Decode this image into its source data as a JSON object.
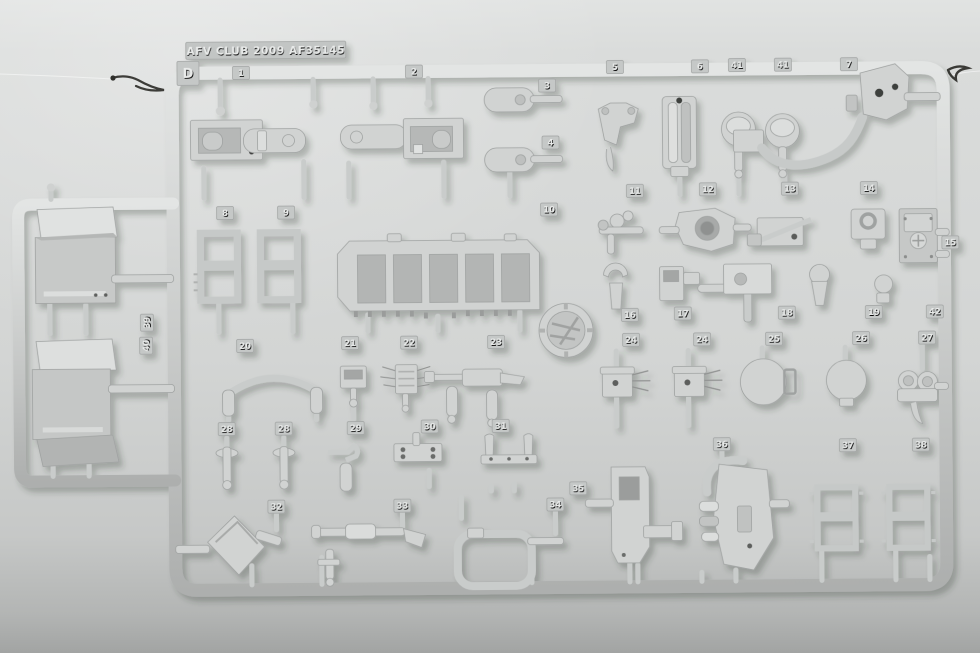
{
  "photo": {
    "brand_plate_text": "AFV CLUB 2009 AF35145",
    "sprue_letter": "D"
  },
  "colors": {
    "background_top": "#e0e2e1",
    "background_mid": "#d5d7d6",
    "background_bottom": "#a6a8a7",
    "plastic_light": "#e0e2e1",
    "plastic_mid": "#cdcfce",
    "plastic_dark": "#b2b4b3",
    "tag_plate": "#c5c8c7",
    "tag_numeral": "#e9ebea",
    "hole_dark": "#4b4d4c"
  },
  "sprue": {
    "letter_tag": {
      "label": "D",
      "x": 190,
      "y": 71,
      "w": 22,
      "h": 24,
      "fs": 13
    },
    "tags": [
      {
        "label": "1",
        "x": 243,
        "y": 71
      },
      {
        "label": "2",
        "x": 416,
        "y": 71
      },
      {
        "label": "3",
        "x": 549,
        "y": 86
      },
      {
        "label": "4",
        "x": 552,
        "y": 143
      },
      {
        "label": "5",
        "x": 617,
        "y": 68
      },
      {
        "label": "6",
        "x": 702,
        "y": 68
      },
      {
        "label": "41",
        "x": 739,
        "y": 67
      },
      {
        "label": "41",
        "x": 785,
        "y": 67
      },
      {
        "label": "7",
        "x": 851,
        "y": 67
      },
      {
        "label": "8",
        "x": 226,
        "y": 211
      },
      {
        "label": "9",
        "x": 287,
        "y": 211
      },
      {
        "label": "10",
        "x": 550,
        "y": 210
      },
      {
        "label": "11",
        "x": 636,
        "y": 192
      },
      {
        "label": "12",
        "x": 709,
        "y": 191
      },
      {
        "label": "13",
        "x": 791,
        "y": 191
      },
      {
        "label": "14",
        "x": 870,
        "y": 191
      },
      {
        "label": "15",
        "x": 951,
        "y": 246
      },
      {
        "label": "16",
        "x": 630,
        "y": 316
      },
      {
        "label": "17",
        "x": 683,
        "y": 315
      },
      {
        "label": "18",
        "x": 787,
        "y": 315
      },
      {
        "label": "19",
        "x": 874,
        "y": 315
      },
      {
        "label": "42",
        "x": 935,
        "y": 315
      },
      {
        "label": "24",
        "x": 631,
        "y": 341
      },
      {
        "label": "24",
        "x": 702,
        "y": 341
      },
      {
        "label": "25",
        "x": 774,
        "y": 341
      },
      {
        "label": "26",
        "x": 861,
        "y": 341
      },
      {
        "label": "27",
        "x": 927,
        "y": 341
      },
      {
        "label": "20",
        "x": 245,
        "y": 344
      },
      {
        "label": "21",
        "x": 350,
        "y": 342
      },
      {
        "label": "22",
        "x": 409,
        "y": 342
      },
      {
        "label": "23",
        "x": 496,
        "y": 342
      },
      {
        "label": "28",
        "x": 226,
        "y": 427
      },
      {
        "label": "28",
        "x": 283,
        "y": 427
      },
      {
        "label": "29",
        "x": 355,
        "y": 427
      },
      {
        "label": "30",
        "x": 429,
        "y": 426
      },
      {
        "label": "31",
        "x": 500,
        "y": 426
      },
      {
        "label": "32",
        "x": 275,
        "y": 505
      },
      {
        "label": "33",
        "x": 401,
        "y": 505
      },
      {
        "label": "34",
        "x": 554,
        "y": 505
      },
      {
        "label": "35",
        "x": 577,
        "y": 489
      },
      {
        "label": "36",
        "x": 721,
        "y": 446
      },
      {
        "label": "37",
        "x": 847,
        "y": 448
      },
      {
        "label": "38",
        "x": 920,
        "y": 448
      },
      {
        "label": "39",
        "x": 147,
        "y": 320,
        "rot": -90
      },
      {
        "label": "40",
        "x": 146,
        "y": 343,
        "rot": -90
      }
    ]
  }
}
